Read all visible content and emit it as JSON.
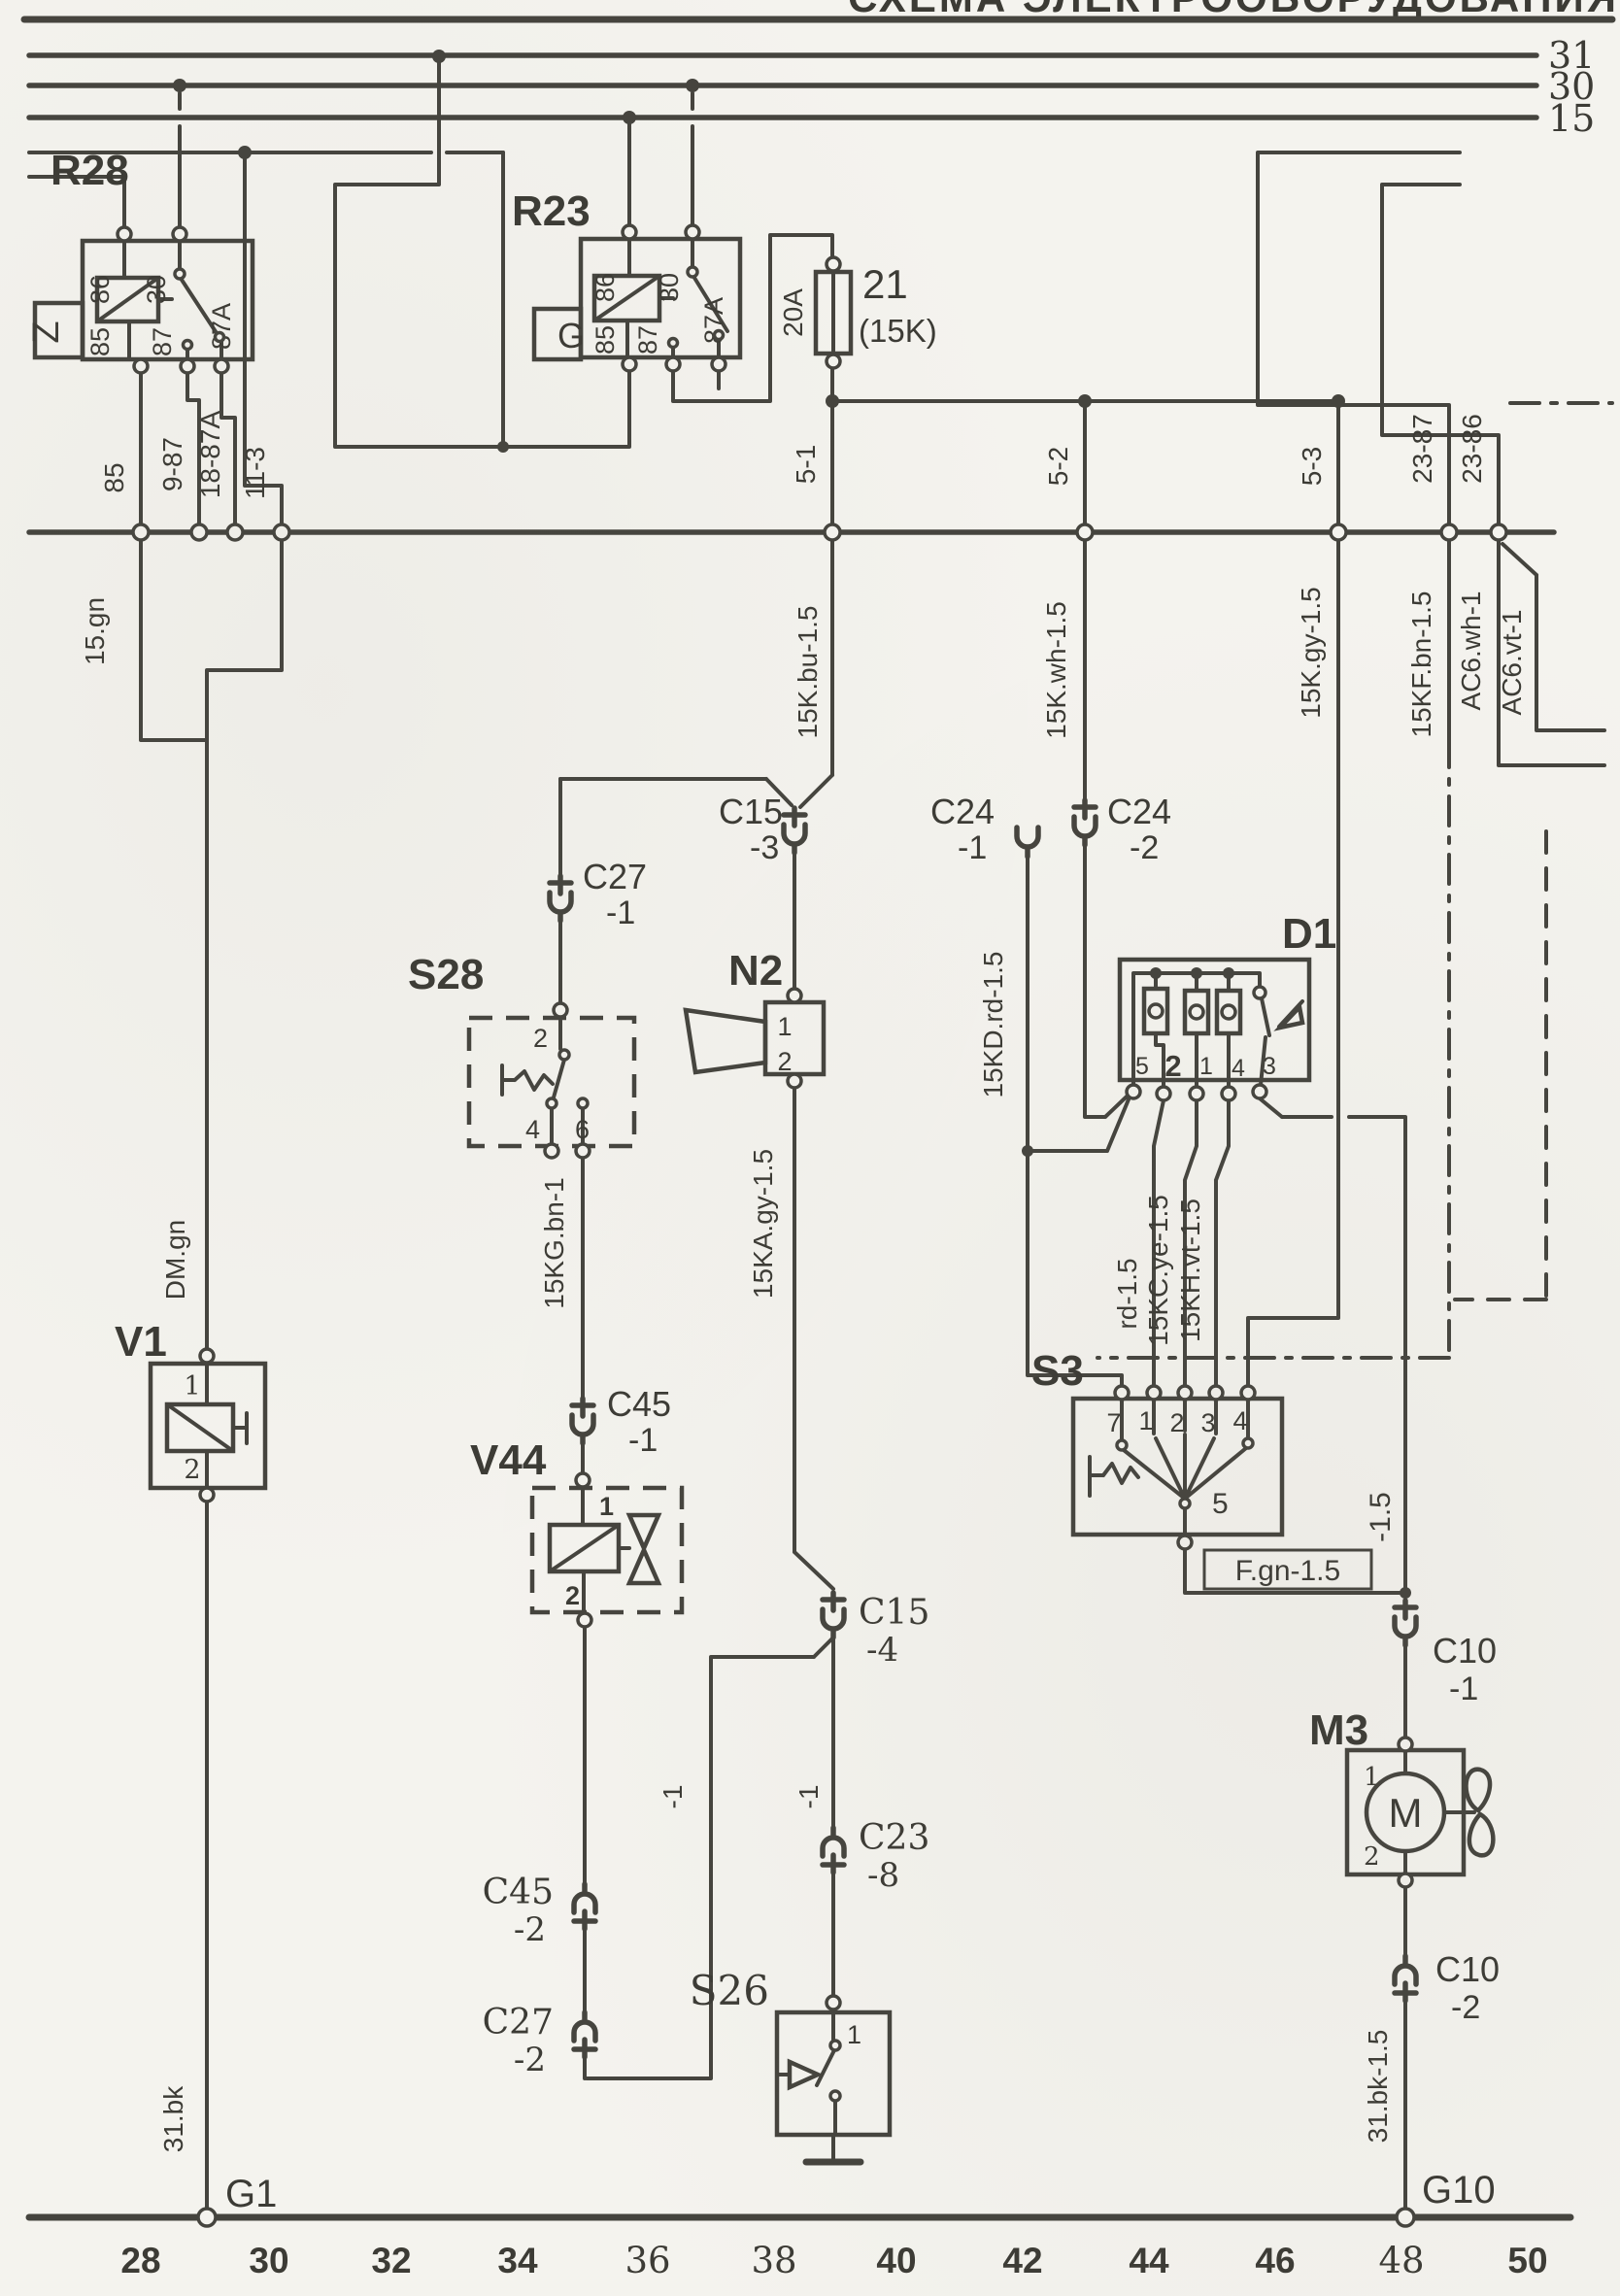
{
  "header": {
    "title": "СХЕМА ЭЛЕКТРООБОРУДОВАНИЯ"
  },
  "buses": {
    "b31": "31",
    "b30": "30",
    "b15": "15"
  },
  "r28": {
    "label": "R28",
    "tag": "Z",
    "t86": "86",
    "t30": "30",
    "t85": "85",
    "t87": "87",
    "t87a": "87A"
  },
  "r23": {
    "label": "R23",
    "tag": "G",
    "t86": "86",
    "t30": "30",
    "t85": "85",
    "t87": "87",
    "t87a": "87A"
  },
  "fuse21": {
    "label": "21",
    "sub": "(15K)",
    "rating": "20A"
  },
  "busrow": {
    "a85": "85",
    "a9_87": "9-87",
    "a18_87a": "18-87A",
    "a11_3": "11-3",
    "a5_1": "5-1",
    "a5_2": "5-2",
    "a5_3": "5-3",
    "a23_87": "23-87",
    "a23_86": "23-86",
    "w15gn": "15.gn",
    "wbu": "15K.bu-1.5",
    "wwh": "15K.wh-1.5",
    "wgy": "15K.gy-1.5",
    "wbn": "15KF.bn-1.5",
    "wac6wh": "AC6.wh-1",
    "wac6vt": "AC6.vt-1"
  },
  "wires": {
    "dm": "DM.gn",
    "bk": "31.bk",
    "bk15": "31.bk-1.5",
    "kg": "15KG.bn-1",
    "ka": "15KA.gy-1.5",
    "kd": "15KD.rd-1.5",
    "rd": "rd-1.5",
    "kc": "15KC.ye-1.5",
    "kh": "15KH.vt-1.5",
    "fgn": "F.gn-1.5",
    "neg15": "-1.5",
    "neg1l": "-1",
    "neg1r": "-1"
  },
  "conn": {
    "c15": "C15",
    "p3": "-3",
    "p4": "-4",
    "c24": "C24",
    "p1": "-1",
    "p2": "-2",
    "c27": "C27",
    "c45": "C45",
    "c23": "C23",
    "p8": "-8",
    "c10": "C10"
  },
  "s28": {
    "label": "S28",
    "t2": "2",
    "t4": "4",
    "t6": "6"
  },
  "n2": {
    "label": "N2",
    "t1": "1",
    "t2": "2"
  },
  "d1": {
    "label": "D1",
    "p5": "5",
    "p2": "2",
    "p1": "1",
    "p4": "4",
    "p3": "3"
  },
  "s3": {
    "label": "S3",
    "p7": "7",
    "p1": "1",
    "p2": "2",
    "p3": "3",
    "p4": "4",
    "p5": "5"
  },
  "v1": {
    "label": "V1",
    "t1": "1",
    "t2": "2"
  },
  "v44": {
    "label": "V44",
    "t1": "1",
    "t2": "2"
  },
  "s26": {
    "label": "S26",
    "t1": "1"
  },
  "m3": {
    "label": "M3",
    "t1": "1",
    "t2": "2",
    "motor": "M"
  },
  "grounds": {
    "g1": "G1",
    "g10": "G10"
  },
  "scale": [
    "28",
    "30",
    "32",
    "34",
    "36",
    "38",
    "40",
    "42",
    "44",
    "46",
    "48",
    "50"
  ]
}
